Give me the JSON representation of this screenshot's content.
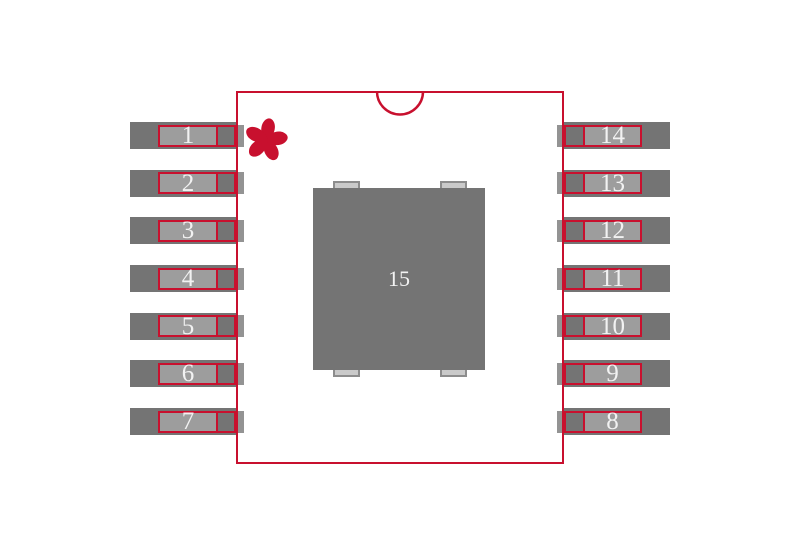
{
  "diagram": {
    "kind": "ic-package-land-pattern",
    "pin1_marker_icon": "asterisk-icon",
    "package_notch": "top-center-semicircle"
  },
  "pins": {
    "left": [
      "1",
      "2",
      "3",
      "4",
      "5",
      "6",
      "7"
    ],
    "right": [
      "14",
      "13",
      "12",
      "11",
      "10",
      "9",
      "8"
    ],
    "thermal": "15"
  },
  "colors": {
    "outline_red": "#c8102e",
    "pad_dark_gray": "#747474",
    "pad_light_gray": "#9d9d9d",
    "pad_strip_gray": "#939393",
    "tab_fill": "#cacaca",
    "tab_border": "#8d8d8d",
    "number_text": "#f2f2f2",
    "background": "#ffffff"
  }
}
